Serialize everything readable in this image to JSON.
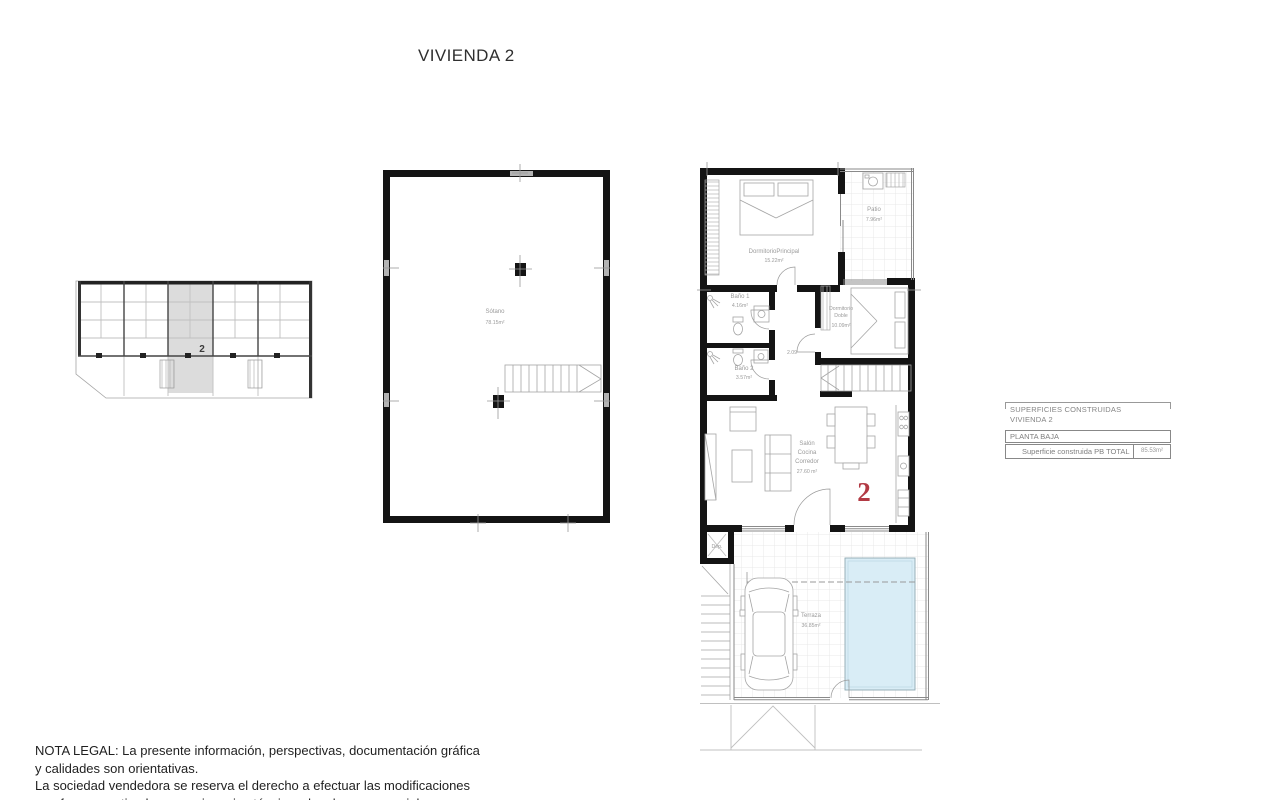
{
  "title": "VIVIENDA 2",
  "key_plan": {
    "unit_number": "2"
  },
  "basement": {
    "name": "Sótano",
    "area": "78.15m²"
  },
  "plan": {
    "unit_number": "2",
    "dormitorio_principal": {
      "name": "DormitorioPrincipal",
      "area": "15.22m²"
    },
    "patio": {
      "name": "Patio",
      "area": "7.96m²"
    },
    "bano1": {
      "name": "Baño 1",
      "area": "4.16m²"
    },
    "bano2": {
      "name": "Baño 2",
      "area": "3.57m²"
    },
    "dormitorio_doble": {
      "name_line1": "Dormitorio",
      "name_line2": "Doble",
      "area": "10.09m²"
    },
    "salon": {
      "name_line1": "Salón",
      "name_line2": "Cocina",
      "name_line3": "Corredor",
      "area": "27.60 m²"
    },
    "pasillo_cota": "2.09",
    "dep": {
      "name": "Dep."
    },
    "terraza": {
      "name": "Terraza",
      "area": "36.85m²"
    }
  },
  "legend": {
    "header_line1": "SUPERFICIES CONSTRUIDAS",
    "header_line2": "VIVIENDA 2",
    "section": "PLANTA BAJA",
    "total_label": "Superficie construida PB TOTAL",
    "total_value": "85.53m²"
  },
  "legal_note": {
    "line1": "NOTA LEGAL: La presente información, perspectivas, documentación gráfica",
    "line2": "y calidades son orientativas.",
    "line3": "La sociedad vendedora se reserva el derecho a efectuar las modificaciones",
    "line4": "que fuesen motivadas por exigencias técnicas, legales o comerciales."
  },
  "colors": {
    "wall": "#141414",
    "pool_fill": "#d9edf6",
    "unit_highlight": "#dcdcdc",
    "accent_red": "#b23a44"
  }
}
